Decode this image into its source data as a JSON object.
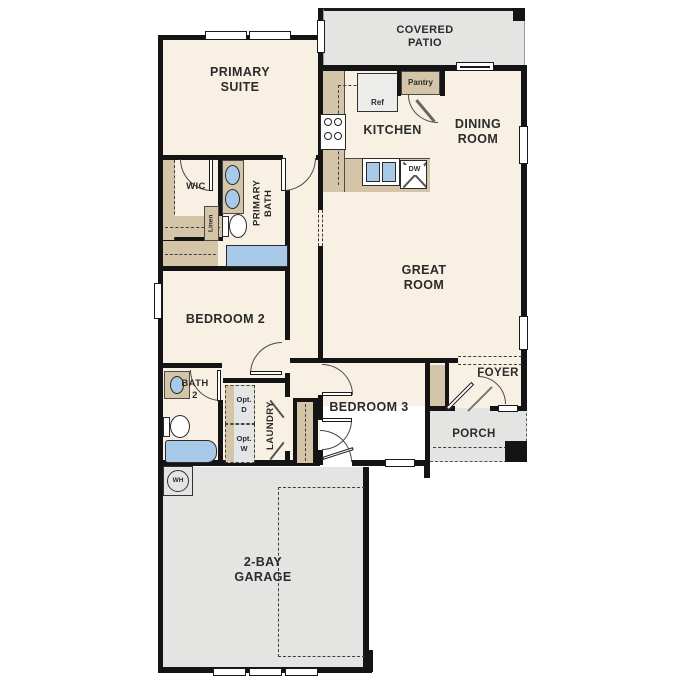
{
  "rooms": {
    "primary_suite": "PRIMARY\nSUITE",
    "covered_patio": "COVERED\nPATIO",
    "kitchen": "KITCHEN",
    "dining_room": "DINING\nROOM",
    "great_room": "GREAT\nROOM",
    "wic": "WIC",
    "primary_bath": "PRIMARY\nBATH",
    "bedroom_2": "BEDROOM 2",
    "bath_2": "BATH\n2",
    "laundry": "LAUNDRY",
    "bedroom_3": "BEDROOM 3",
    "foyer": "FOYER",
    "porch": "PORCH",
    "garage": "2-BAY\nGARAGE"
  },
  "fixtures": {
    "ref": "Ref",
    "pantry": "Pantry",
    "dw": "DW",
    "linen": "Linen",
    "opt_d": "Opt.\nD",
    "opt_w": "Opt.\nW",
    "wh": "WH"
  },
  "colors": {
    "floor": "#f8f0e3",
    "outdoor": "#e4e4e2",
    "cabinet": "#d4c5a8",
    "water": "#a9c9e9",
    "wall": "#141414",
    "text": "#2b2b2b"
  }
}
